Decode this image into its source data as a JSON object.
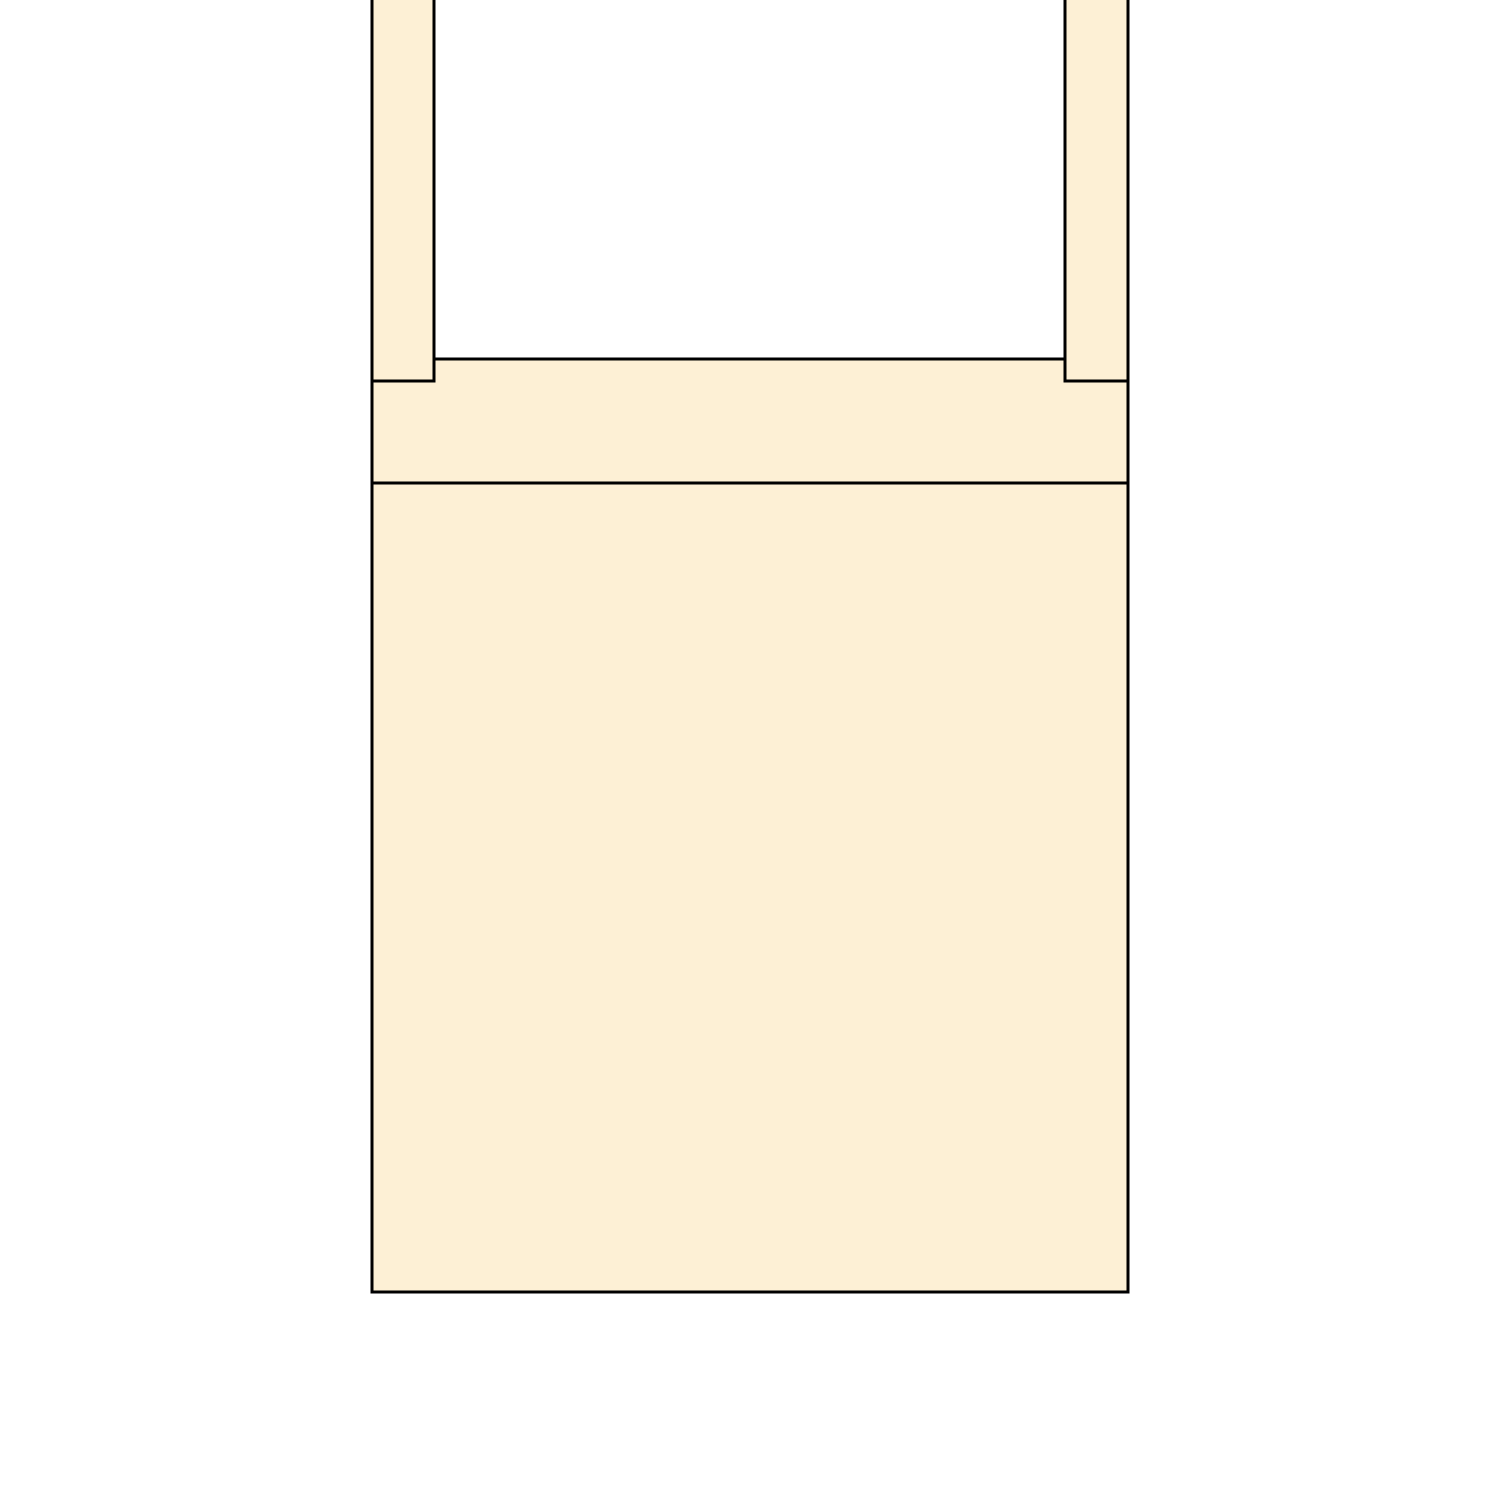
{
  "diagram": {
    "description": "outline-cross-section-diagram",
    "background_color": "#FFFFFF",
    "fill_color": "#FDF0D5",
    "stroke_color": "#000000",
    "stroke_width": 3,
    "shapes": [
      {
        "name": "cross-rail",
        "x": 372,
        "y": 359,
        "width": 756,
        "height": 124
      },
      {
        "name": "lower-panel",
        "x": 372,
        "y": 483,
        "width": 756,
        "height": 809
      },
      {
        "name": "left-post",
        "x": 372,
        "y": -10,
        "width": 62,
        "height": 391
      },
      {
        "name": "right-post",
        "x": 1065,
        "y": -10,
        "width": 63,
        "height": 391
      }
    ]
  }
}
